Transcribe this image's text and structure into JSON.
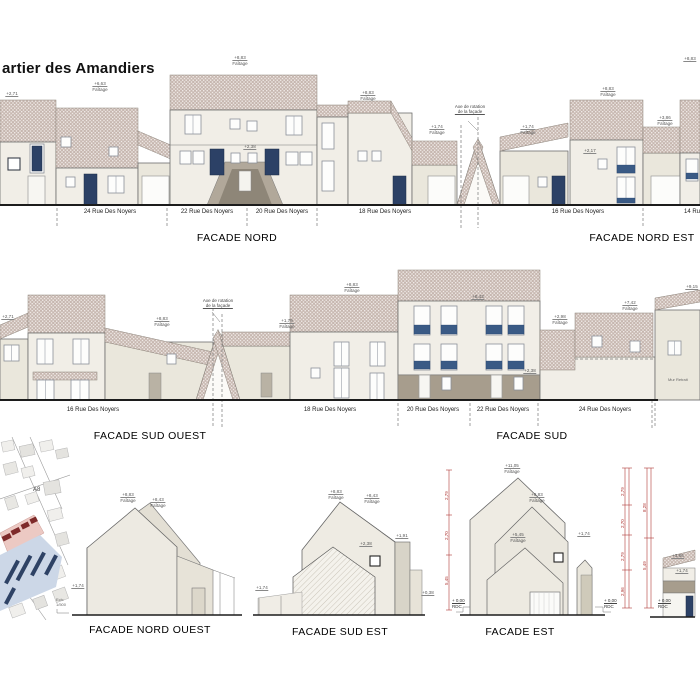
{
  "page": {
    "title": "artier des Amandiers"
  },
  "facade_titles": {
    "nord": "FACADE NORD",
    "nord_est": "FACADE NORD EST",
    "sud_ouest": "FACADE SUD OUEST",
    "sud": "FACADE SUD",
    "nord_ouest": "FACADE NORD OUEST",
    "sud_est": "FACADE SUD EST",
    "est": "FACADE EST"
  },
  "addresses_nord": [
    {
      "text": "24 Rue  Des Noyers"
    },
    {
      "text": "22 Rue  Des Noyers"
    },
    {
      "text": "20 Rue  Des Noyers"
    },
    {
      "text": "18 Rue  Des Noyers"
    },
    {
      "text": "16 Rue  Des Noyers"
    },
    {
      "text": "14 Ru"
    }
  ],
  "addresses_sud": [
    {
      "text": "16 Rue  Des Noyers"
    },
    {
      "text": "18 Rue  Des Noyers"
    },
    {
      "text": "20 Rue  Des Noyers"
    },
    {
      "text": "22 Rue  Des Noyers"
    },
    {
      "text": "24 Rue  Des Noyers"
    }
  ],
  "notes": {
    "axis_line1": "Axe de rotation",
    "axis_line2": "de la façade",
    "retrait": "Mur Retrait",
    "map_zone": "A8",
    "scale_label": "Ech:",
    "scale": "1/500",
    "rdc_value": "+ 0,00",
    "rdc_label": "RDC"
  },
  "markers": [
    {
      "text": "+2,71",
      "sub": ""
    },
    {
      "text": "+6,63",
      "sub": "Faîtage"
    },
    {
      "text": "+8,83",
      "sub": "Faîtage"
    },
    {
      "text": "+8,83",
      "sub": "Faîtage"
    },
    {
      "text": "+1,74",
      "sub": "Faîtage"
    },
    {
      "text": "+2,38",
      "sub": ""
    },
    {
      "text": "+1,74",
      "sub": "Faîtage"
    },
    {
      "text": "+8,83",
      "sub": "Faîtage"
    },
    {
      "text": "+3,86",
      "sub": "Faîtage"
    },
    {
      "text": "+8,83",
      "sub": ""
    },
    {
      "text": "+2,17",
      "sub": ""
    },
    {
      "text": "+2,71",
      "sub": ""
    },
    {
      "text": "+8,83",
      "sub": "Faîtage"
    },
    {
      "text": "+1,79",
      "sub": "Faîtage"
    },
    {
      "text": "+8,83",
      "sub": "Faîtage"
    },
    {
      "text": "+8,43",
      "sub": ""
    },
    {
      "text": "+2,98",
      "sub": "Faîtage"
    },
    {
      "text": "+7,42",
      "sub": "Faîtage"
    },
    {
      "text": "+9,15",
      "sub": ""
    },
    {
      "text": "+2,38",
      "sub": ""
    },
    {
      "text": "+8,83",
      "sub": "Faîtage"
    },
    {
      "text": "+8,43",
      "sub": "Faîtage"
    },
    {
      "text": "+1,74",
      "sub": ""
    },
    {
      "text": "+8,83",
      "sub": "Faîtage"
    },
    {
      "text": "+8,43",
      "sub": "Faîtage"
    },
    {
      "text": "+2,38",
      "sub": ""
    },
    {
      "text": "+1,91",
      "sub": ""
    },
    {
      "text": "+1,74",
      "sub": ""
    },
    {
      "text": "+0,38",
      "sub": ""
    },
    {
      "text": "+11,05",
      "sub": "Faîtage"
    },
    {
      "text": "+8,83",
      "sub": "Faîtage"
    },
    {
      "text": "+5,45",
      "sub": "Faîtage"
    },
    {
      "text": "+1,74",
      "sub": ""
    },
    {
      "text": "+3,86",
      "sub": ""
    },
    {
      "text": "+1,74",
      "sub": ""
    }
  ],
  "dims": [
    {
      "v": "2,79"
    },
    {
      "v": "2,70"
    },
    {
      "v": "5,45"
    },
    {
      "v": "2,79"
    },
    {
      "v": "2,70"
    },
    {
      "v": "2,79"
    },
    {
      "v": "2,96"
    },
    {
      "v": "8,28"
    },
    {
      "v": "5,49"
    }
  ],
  "colors": {
    "roof": "#c7b7b0",
    "wall": "#f1eee7",
    "wall_shade": "#eae7dc",
    "taupe": "#a79d8d",
    "door_navy": "#2c4166",
    "balcony": "#3a5a85",
    "dim_red": "#b03a37",
    "site_red": "#7e2a2a",
    "site_pink": "#ecc9c3",
    "site_blue": "#ccd7e7",
    "site_navy": "#2e4265"
  }
}
